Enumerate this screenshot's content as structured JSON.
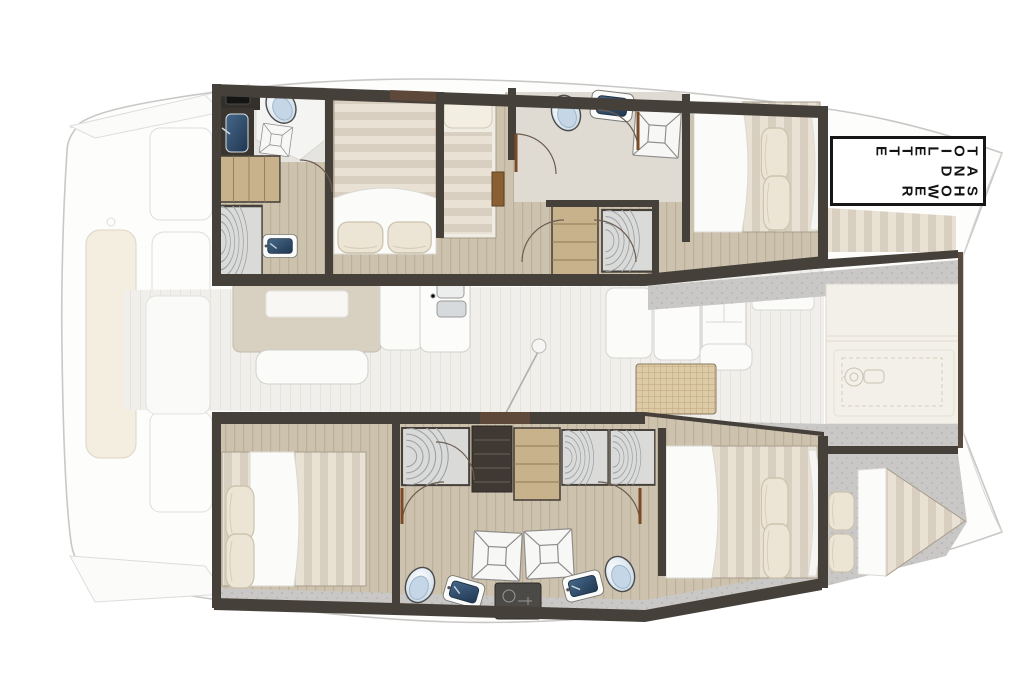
{
  "document": {
    "kind": "catamaran-yacht-floor-plan",
    "background": "#ffffff"
  },
  "label_box": {
    "lines": [
      "TOILETTE",
      "AND",
      "SHOWER"
    ],
    "reading": "TOILETTE AND SHOWER",
    "letters_rotated_deg": 90,
    "lines_read_right_to_left": true,
    "border_color": "#161616",
    "background": "#ffffff",
    "text_color": "#141414"
  },
  "palette": {
    "background": "#ffffff",
    "hull_outline": "#c9c8c6",
    "hull_fill": "#fdfdfc",
    "wall_dark": "#46403a",
    "wall_brown": "#5d4839",
    "wood_floor": "#cdc2ad",
    "wood_line": "#bcb09a",
    "saloon_floor": "#f1efeb",
    "ivory_deck": "#f3f0e9",
    "speckle_gray": "#c9c8c6",
    "mattress_light": "#e8e1d4",
    "mattress_dark": "#d9cfc0",
    "duvet_white": "#fbfbf9",
    "pillow_cream": "#ece5d5",
    "navy_sink": "#2c4760",
    "toilet_blue": "#c5d7e6",
    "table_beige": "#d8d1c2",
    "bench_white": "#fbfbf9",
    "woven_table": "#ddcaa6",
    "stairs_wood": "#c7b28c",
    "locker_gray": "#dadad8",
    "door_arc": "#6b5d52",
    "door_leaf": "#7a4a28",
    "sunpad_cream": "#f4eee0"
  },
  "inventory": {
    "port_hull": [
      "aft-head",
      "aft-cabin-double-berth",
      "single-berth",
      "forward-head",
      "forward-cabin-double-berth",
      "forepeak-berth"
    ],
    "starboard_hull": [
      "aft-cabin-double-berth",
      "wardrobes",
      "stairs",
      "shower-stall-left",
      "shower-stall-right",
      "toilets",
      "sinks",
      "forward-cabin-double-berth",
      "forepeak-cabin"
    ],
    "saloon": [
      "cockpit-table",
      "bench",
      "galley-island",
      "double-sink",
      "mast-step",
      "sofa",
      "fridge-cabinet",
      "woven-table"
    ],
    "foredeck": [
      "deck-panels",
      "anchor-windlass",
      "anchor-locker"
    ],
    "aft_deck": [
      "sunpad",
      "swim-platform-steps"
    ]
  }
}
